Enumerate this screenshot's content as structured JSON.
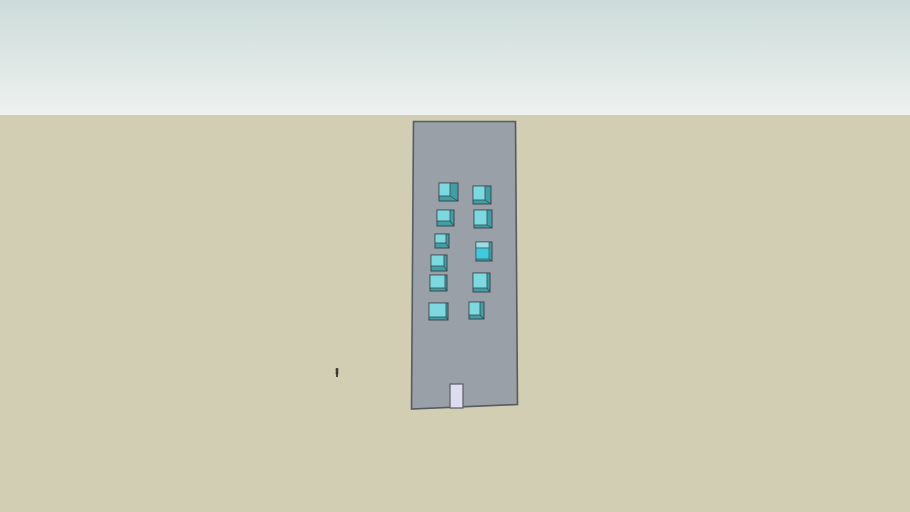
{
  "scene": {
    "width": 910,
    "height": 512,
    "sky": {
      "top_color": "#ccdcda",
      "horizon_color": "#eef1ef",
      "horizon_y": 115
    },
    "ground": {
      "color": "#d2ceb3"
    },
    "building": {
      "facade_color": "#9aa0a7",
      "outline_color": "#555b61",
      "polygon": [
        [
          413.5,
          121.5
        ],
        [
          515.5,
          121.5
        ],
        [
          517.5,
          404.5
        ],
        [
          411.5,
          409
        ]
      ]
    },
    "windows": {
      "glass_color": "#7bd9df",
      "depth_color": "#3f9ea6",
      "outline_color": "#39494d",
      "items": [
        {
          "x": 439,
          "y": 183,
          "w": 19,
          "h": 18,
          "right": 8,
          "bottom": 5
        },
        {
          "x": 437,
          "y": 210,
          "w": 17,
          "h": 16,
          "right": 4,
          "bottom": 5
        },
        {
          "x": 435,
          "y": 234,
          "w": 14,
          "h": 14,
          "right": 3,
          "bottom": 5
        },
        {
          "x": 431,
          "y": 255,
          "w": 16,
          "h": 16,
          "right": 3,
          "bottom": 5
        },
        {
          "x": 430,
          "y": 275,
          "w": 17,
          "h": 16,
          "right": 2,
          "bottom": 3
        },
        {
          "x": 429,
          "y": 303,
          "w": 19,
          "h": 17,
          "right": 2,
          "bottom": 3
        },
        {
          "x": 473,
          "y": 186,
          "w": 18,
          "h": 18,
          "right": 6,
          "bottom": 4
        },
        {
          "x": 474,
          "y": 210,
          "w": 18,
          "h": 18,
          "right": 5,
          "bottom": 3
        },
        {
          "x": 476,
          "y": 242,
          "w": 16,
          "h": 19,
          "right": 3,
          "bottom": 2,
          "top_band": 6,
          "top_band_color": "#9edce2",
          "glass_color": "#3ec9dc"
        },
        {
          "x": 473,
          "y": 273,
          "w": 17,
          "h": 19,
          "right": 3,
          "bottom": 4
        },
        {
          "x": 469,
          "y": 302,
          "w": 15,
          "h": 17,
          "right": 4,
          "bottom": 4
        }
      ]
    },
    "door": {
      "x": 450,
      "y": 384,
      "w": 13,
      "h": 24,
      "color": "#dddcf1",
      "outline_color": "#5c5c68"
    },
    "person": {
      "x": 337,
      "y": 368,
      "height": 9,
      "color": "#3c352b"
    }
  }
}
